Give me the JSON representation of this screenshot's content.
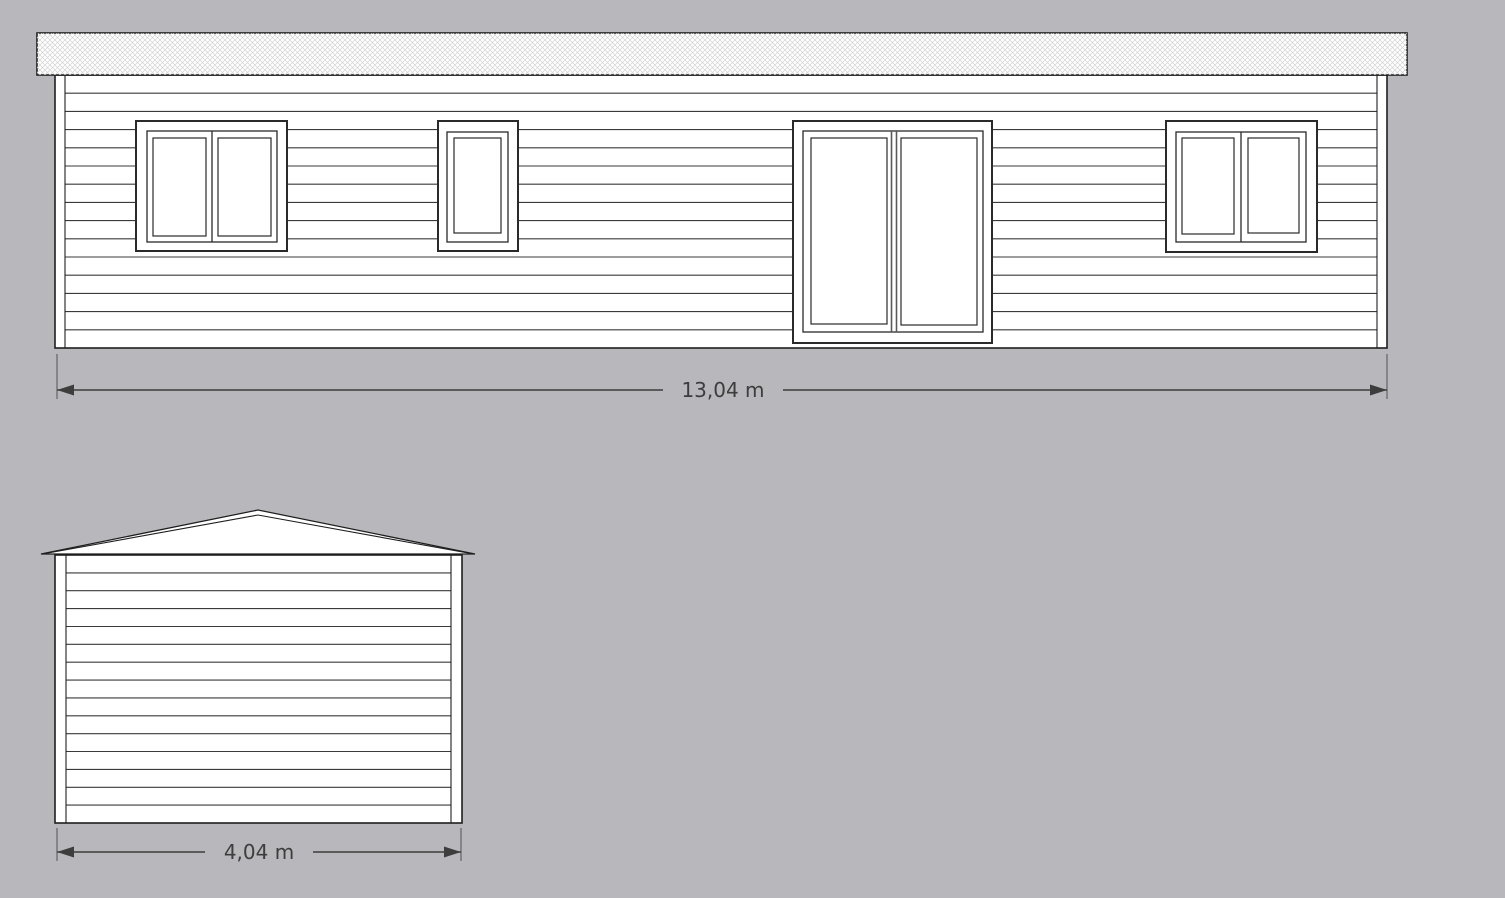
{
  "drawing": {
    "title": "log-cabin-elevation-drawing",
    "colors": {
      "background": "#b7b7bc",
      "line": "#1f1f1f",
      "siding_line": "#3a3a3a",
      "fill": "#ffffff",
      "hatch": "#d2d2d2",
      "dimension": "#3d3d3d"
    },
    "front_elevation": {
      "name": "front elevation",
      "dimension_label": "13,04 m",
      "feature_names": [
        "double-window-left",
        "single-window",
        "double-door",
        "double-window-right"
      ]
    },
    "side_elevation": {
      "name": "side gable elevation",
      "dimension_label": "4,04 m"
    }
  }
}
